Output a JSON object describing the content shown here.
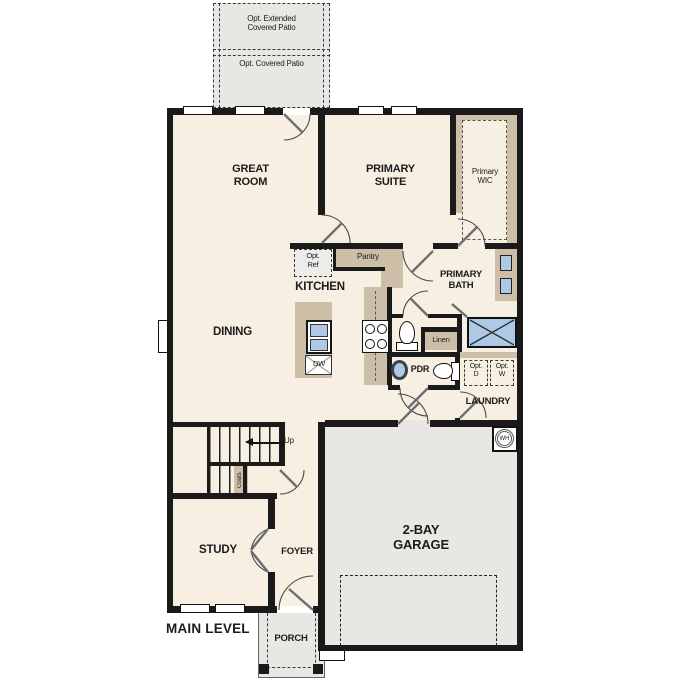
{
  "colors": {
    "wall": "#1a1a1a",
    "floor": "#f6efe2",
    "gray": "#e8e7e4",
    "tan": "#cdbfa7",
    "blue": "#adc9e5"
  },
  "labels": {
    "opt_extended_patio": "Opt. Extended\nCovered Patio",
    "opt_covered_patio": "Opt. Covered Patio",
    "great_room": "GREAT\nROOM",
    "primary_suite": "PRIMARY\nSUITE",
    "primary_wic": "Primary\nWIC",
    "opt_ref": "Opt.\nRef",
    "pantry": "Pantry",
    "kitchen": "KITCHEN",
    "primary_bath": "PRIMARY\nBATH",
    "dining": "DINING",
    "dw": "DW",
    "linen": "Linen",
    "pdr": "PDR",
    "opt_d": "Opt.\nD",
    "opt_w": "Opt.\nW",
    "laundry": "LAUNDRY",
    "up": "Up",
    "coats": "Coats",
    "wh": "WH",
    "study": "STUDY",
    "foyer": "FOYER",
    "garage": "2-BAY\nGARAGE",
    "main_level": "MAIN LEVEL",
    "porch": "PORCH"
  }
}
